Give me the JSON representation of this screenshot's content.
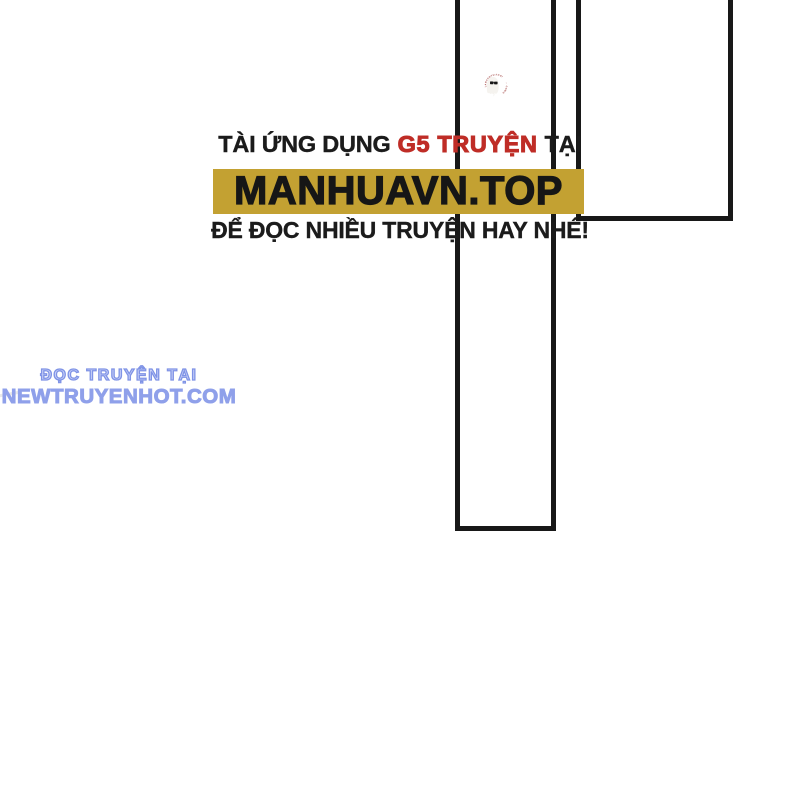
{
  "app_watermark": {
    "line1_prefix": "TÀI ỨNG DỤNG",
    "line1_highlight": "G5 TRUYỆN",
    "line1_suffix": "TẠI",
    "banner_text": "MANHUAVN.TOP",
    "line3": "ĐỂ ĐỌC NHIỀU TRUYỆN HAY NHÉ!",
    "colors": {
      "highlight_red": "#bf2d27",
      "banner_bg": "#c3a132",
      "text_black": "#1b1b1b"
    }
  },
  "ghost_logo": {
    "arc_text": "LAMCHOVUITHOI",
    "arc_separator": "▪▪",
    "arc_text2": "COMIC",
    "colors": {
      "arc_red": "#9a3533",
      "ghost_body": "#f5f3ef",
      "sunglasses": "#161616"
    }
  },
  "site_watermark": {
    "line1": "ĐỌC TRUYỆN TẠI",
    "line2": "NEWTRUYENHOT.COM",
    "colors": {
      "bubble_fill": "#c9d1f7",
      "bubble_outline": "#7f93e6",
      "line2_blue": "#8fa0ea"
    }
  },
  "panels": {
    "border_color": "#181818"
  }
}
